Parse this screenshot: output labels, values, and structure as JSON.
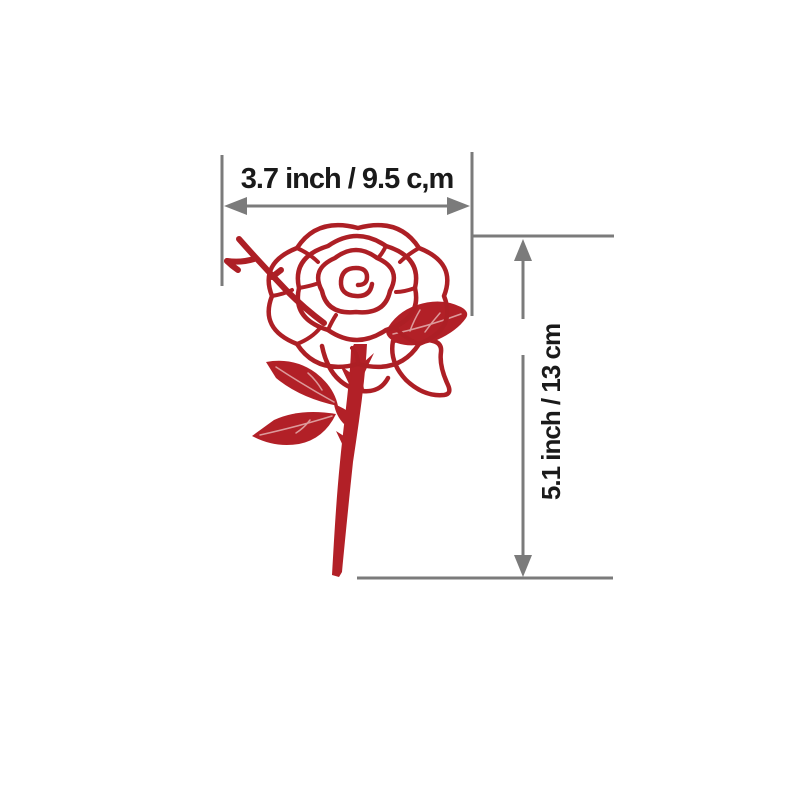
{
  "figure": {
    "type": "product-dimension-diagram",
    "subject": "red rose line-art illustration (cutting die / decal)",
    "width_label": "3.7 inch / 9.5 c,m",
    "height_label": "5.1 inch / 13 cm"
  },
  "colors": {
    "background": "#ffffff",
    "rose_red_fill": "#b22027",
    "rose_red_outline": "#ad1f25",
    "leaf_vein": "#dd9a9b",
    "dimension_gray": "#7b7b7b",
    "label_text": "#1a1a1a"
  }
}
